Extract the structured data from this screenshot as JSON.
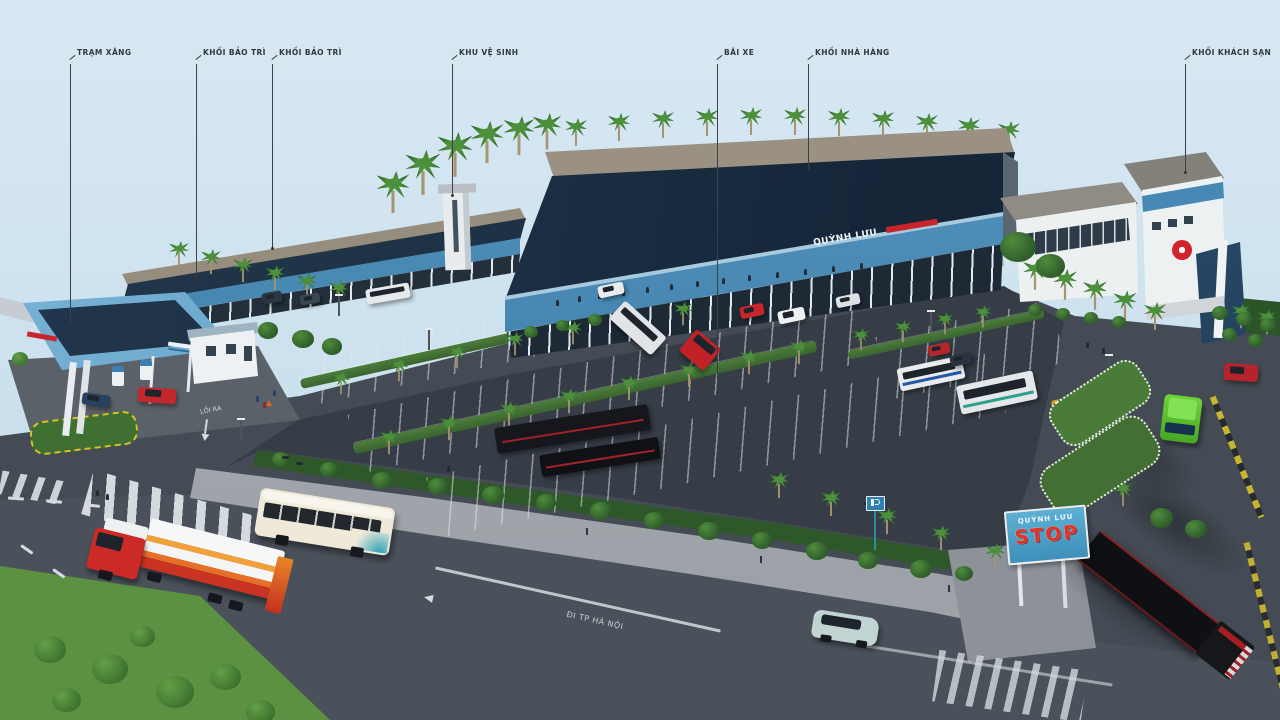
{
  "callouts": [
    {
      "id": "gas-station",
      "label": "TRẠM XĂNG"
    },
    {
      "id": "maintenance-block-1",
      "label": "KHỐI BẢO TRÌ"
    },
    {
      "id": "maintenance-block-2",
      "label": "KHỐI BẢO TRÌ"
    },
    {
      "id": "restroom-area",
      "label": "KHU VỆ SINH"
    },
    {
      "id": "parking-lot",
      "label": "BÃI XE"
    },
    {
      "id": "restaurant-block",
      "label": "KHỐI NHÀ HÀNG"
    },
    {
      "id": "hotel-block",
      "label": "KHỐI KHÁCH SẠN"
    }
  ],
  "signs": {
    "building_fascia": "QUỲNH LƯU",
    "pylon_top": "QUỲNH LƯU",
    "pylon_main": "STOP",
    "road_exit": "LỐI RA",
    "road_direction": "ĐI TP HÀ NỘI"
  },
  "palette": {
    "sky": "#cfe2ee",
    "roof_navy": "#1c2f43",
    "fascia_blue": "#4788b4",
    "ridge_tan": "#9a9183",
    "asphalt": "#3a4049",
    "road": "#4a515a",
    "walkway": "#a2a8ad",
    "grass": "#5b9140",
    "hedge": "#2e5829",
    "sign_blue": "#4aa3cc",
    "stop_red": "#e03228",
    "logo_red": "#d2232a"
  }
}
